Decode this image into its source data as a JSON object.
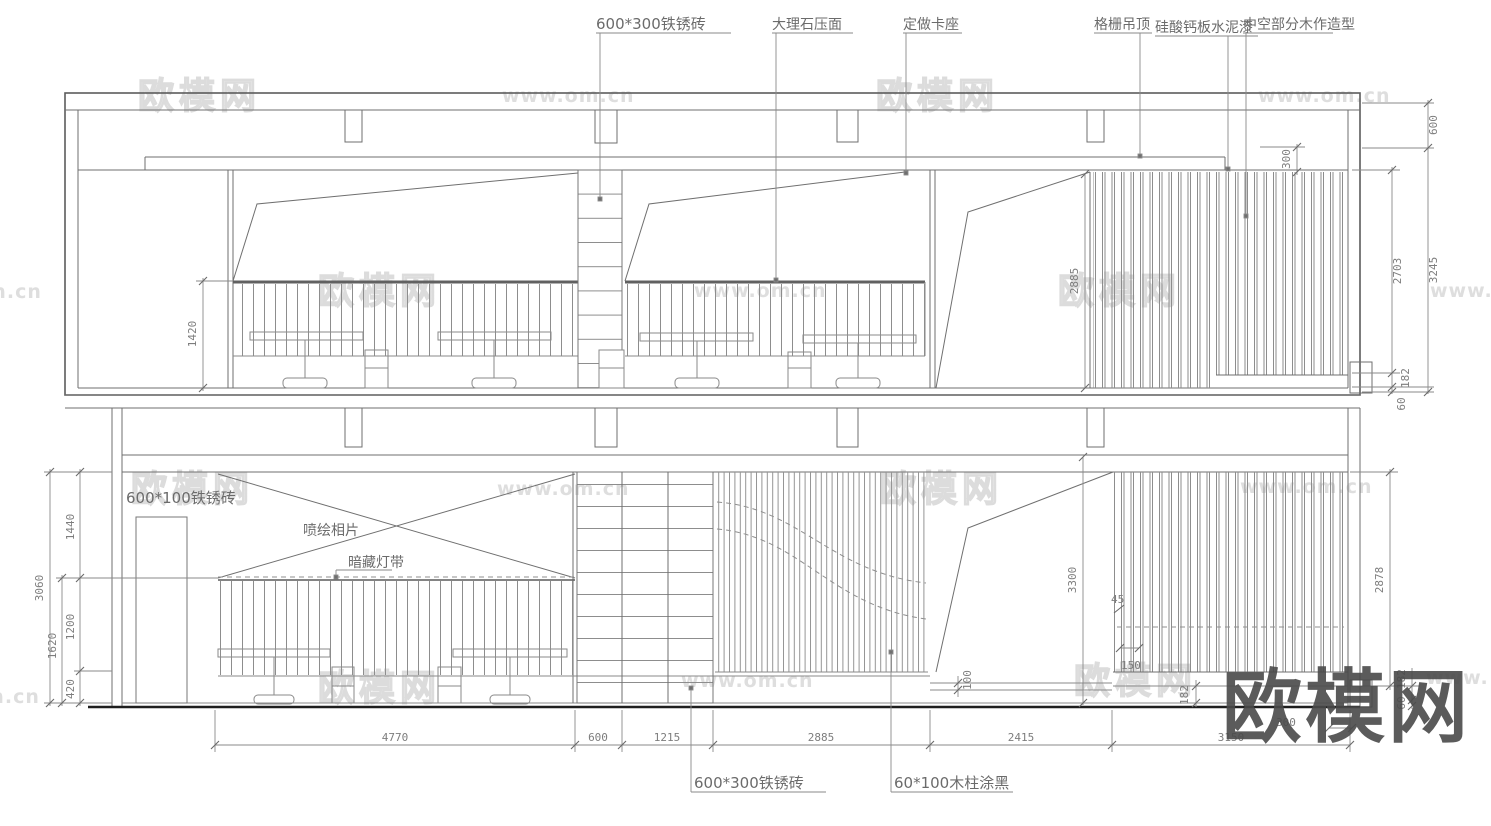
{
  "drawing_type": "interior elevation cad drawing",
  "callouts": {
    "top": {
      "brick_600x300": "600*300铁锈砖",
      "marble_counter": "大理石压面",
      "custom_booth": "定做卡座",
      "grille_ceiling": "格栅吊顶",
      "silicate_cement_paint": "硅酸钙板水泥漆",
      "hollow_wood_feature": "中空部分木作造型"
    },
    "bottom": {
      "brick_600x100": "600*100铁锈砖",
      "inkjet_photo": "喷绘相片",
      "hidden_light_strip": "暗藏灯带",
      "brick_600x300": "600*300铁锈砖",
      "wood_post_black": "60*100木柱涂黑"
    }
  },
  "dimensions": {
    "upper": {
      "right_outer": [
        "600",
        "3245"
      ],
      "right_inner": [
        "2703",
        "182",
        "60"
      ],
      "ceiling_300": "300",
      "mid_2885": "2885",
      "left_1420": "1420"
    },
    "lower": {
      "left_total": "3060",
      "left_1620": "1620",
      "left_chain": [
        "1440",
        "1200",
        "420"
      ],
      "right_3300": "3300",
      "right_2878": "2878",
      "right_chain": [
        "182",
        "60"
      ],
      "panel_45": "45",
      "panel_150": "150",
      "skirt_100": "100",
      "skirt_182": "182",
      "bottom_row": [
        "4770",
        "600",
        "1215",
        "2885",
        "2415",
        "3150"
      ],
      "bottom_300": "300"
    }
  },
  "watermarks": {
    "brand": "欧模网",
    "site": "www.om.cn",
    "site_short": "om.cn",
    "site_fragment": "www.",
    "corner_brand": "欧模网"
  }
}
